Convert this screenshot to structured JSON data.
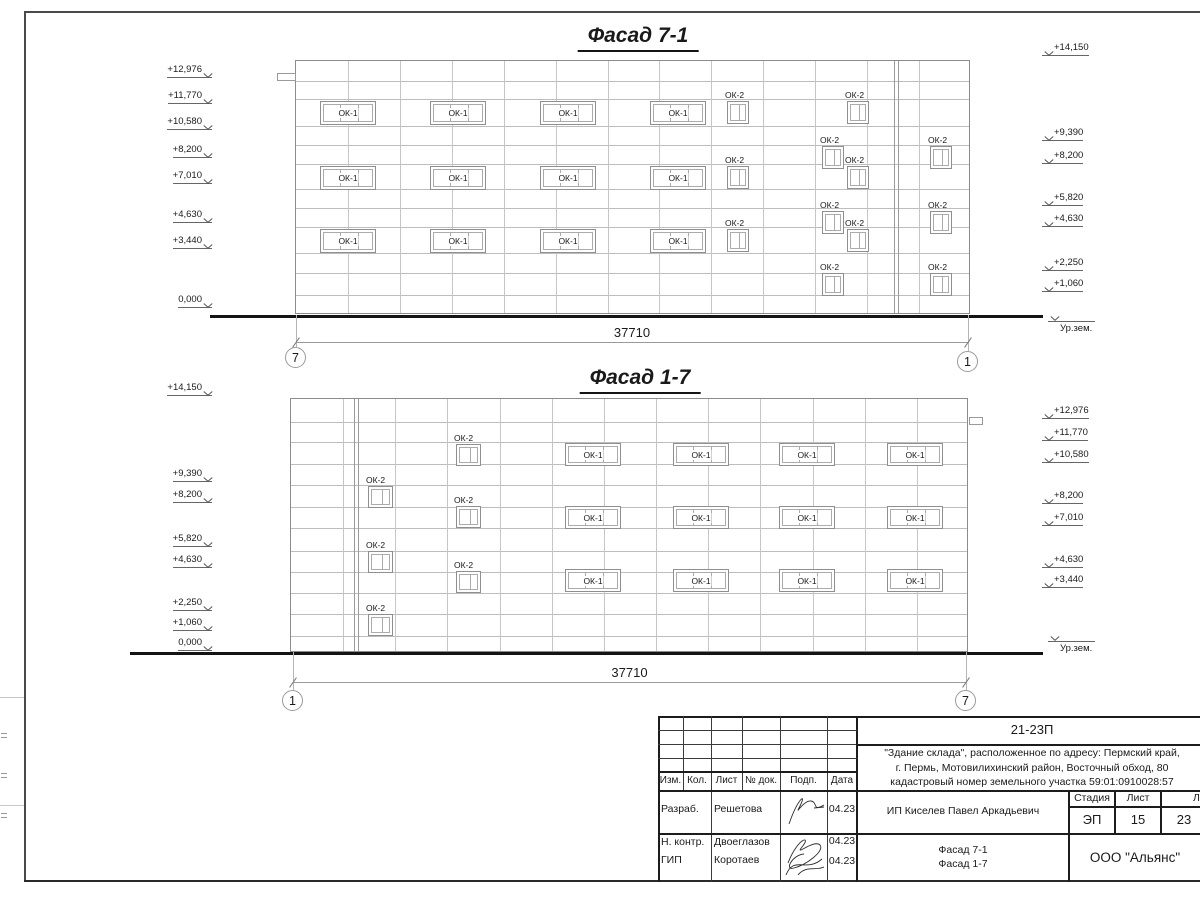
{
  "sheet": {
    "width": 1200,
    "height": 900
  },
  "facades": [
    {
      "id": "top",
      "title": "Фасад 7-1",
      "title_x": 638,
      "title_y": 24,
      "bx": 295,
      "by": 60,
      "bw": 675,
      "bh": 254,
      "h_lines": [
        20,
        38,
        65,
        84,
        103,
        128,
        147,
        166,
        192,
        212,
        234
      ],
      "v_bays": 13,
      "double_v": [
        598,
        602
      ],
      "ok1": {
        "label": "ОК-1",
        "w": 56,
        "h": 24,
        "cols": [
          24,
          134,
          244,
          354
        ],
        "rows": [
          40,
          105,
          168
        ]
      },
      "ok2": {
        "label": "ОК-2",
        "w": 22,
        "h": 23,
        "items": [
          [
            431,
            40
          ],
          [
            431,
            105
          ],
          [
            431,
            168
          ],
          [
            551,
            40
          ],
          [
            551,
            105
          ],
          [
            551,
            168
          ],
          [
            526,
            85
          ],
          [
            526,
            150
          ],
          [
            526,
            212
          ],
          [
            634,
            85
          ],
          [
            634,
            150
          ],
          [
            634,
            212
          ]
        ]
      },
      "tab": {
        "x": 277,
        "y": 73,
        "w": 19,
        "h": 8
      },
      "ground": {
        "x1": 210,
        "x2": 1043,
        "y": 315
      },
      "dim": {
        "label": "37710",
        "x1": 296,
        "x2": 968,
        "y": 342
      },
      "axes": [
        {
          "label": "7",
          "cx": 296,
          "cy": 358
        },
        {
          "label": "1",
          "cx": 968,
          "cy": 362
        }
      ],
      "marks_left": [
        [
          "+12,976",
          67
        ],
        [
          "+11,770",
          93
        ],
        [
          "+10,580",
          119
        ],
        [
          "+8,200",
          147
        ],
        [
          "+7,010",
          173
        ],
        [
          "+4,630",
          212
        ],
        [
          "+3,440",
          238
        ],
        [
          "0,000",
          297
        ]
      ],
      "marks_right": [
        [
          "+14,150",
          45
        ],
        [
          "+9,390",
          130
        ],
        [
          "+8,200",
          153
        ],
        [
          "+5,820",
          195
        ],
        [
          "+4,630",
          216
        ],
        [
          "+2,250",
          260
        ],
        [
          "+1,060",
          281
        ]
      ],
      "ground_label": {
        "text": "Ур.зем.",
        "x": 1048,
        "y": 318
      }
    },
    {
      "id": "bottom",
      "title": "Фасад 1-7",
      "title_x": 640,
      "title_y": 366,
      "bx": 290,
      "by": 398,
      "bw": 678,
      "bh": 254,
      "h_lines": [
        23,
        43,
        65,
        86,
        108,
        129,
        152,
        173,
        194,
        215,
        237
      ],
      "v_bays": 13,
      "double_v": [
        63,
        67
      ],
      "ok1": {
        "label": "ОК-1",
        "w": 56,
        "h": 23,
        "cols": [
          274,
          382,
          488,
          596
        ],
        "rows": [
          44,
          107,
          170
        ]
      },
      "ok2": {
        "label": "ОК-2",
        "w": 25,
        "h": 22,
        "items": [
          [
            77,
            87
          ],
          [
            77,
            152
          ],
          [
            77,
            215
          ],
          [
            165,
            45
          ],
          [
            165,
            107
          ],
          [
            165,
            172
          ]
        ]
      },
      "tab": {
        "x": 969,
        "y": 417,
        "w": 14,
        "h": 8
      },
      "ground": {
        "x1": 130,
        "x2": 1043,
        "y": 652
      },
      "dim": {
        "label": "37710",
        "x1": 293,
        "x2": 966,
        "y": 682
      },
      "axes": [
        {
          "label": "1",
          "cx": 293,
          "cy": 701
        },
        {
          "label": "7",
          "cx": 966,
          "cy": 701
        }
      ],
      "marks_left": [
        [
          "+14,150",
          385
        ],
        [
          "+9,390",
          471
        ],
        [
          "+8,200",
          492
        ],
        [
          "+5,820",
          536
        ],
        [
          "+4,630",
          557
        ],
        [
          "+2,250",
          600
        ],
        [
          "+1,060",
          620
        ],
        [
          "0,000",
          640
        ]
      ],
      "marks_right": [
        [
          "+12,976",
          408
        ],
        [
          "+11,770",
          430
        ],
        [
          "+10,580",
          452
        ],
        [
          "+8,200",
          493
        ],
        [
          "+7,010",
          515
        ],
        [
          "+4,630",
          557
        ],
        [
          "+3,440",
          577
        ]
      ],
      "ground_label": {
        "text": "Ур.зем.",
        "x": 1048,
        "y": 638
      }
    }
  ],
  "titleblock": {
    "doc_number": "21-23П",
    "description": "\"Здание склада\", расположенное по адресу: Пермский край,\nг. Пермь, Мотовилихинский район, Восточный обход, 80\nкадастровый номер земельного участка 59:01:0910028:57",
    "cols": [
      "Изм.",
      "Кол.",
      "Лист",
      "№ док.",
      "Подп.",
      "Дата"
    ],
    "rows": [
      {
        "role": "Разраб.",
        "name": "Решетова",
        "date": "04.23"
      },
      {
        "role": "Н. контр.",
        "name": "Двоеглазов",
        "date": "04.23"
      },
      {
        "role": "ГИП",
        "name": "Коротаев",
        "date": "04.23"
      }
    ],
    "customer": "ИП Киселев Павел Аркадьевич",
    "stage_cols": [
      "Стадия",
      "Лист",
      "Листов"
    ],
    "stage_vals": [
      "ЭП",
      "15",
      "23"
    ],
    "sheet_name": "Фасад 7-1\nФасад 1-7",
    "company": "ООО \"Альянс\""
  }
}
